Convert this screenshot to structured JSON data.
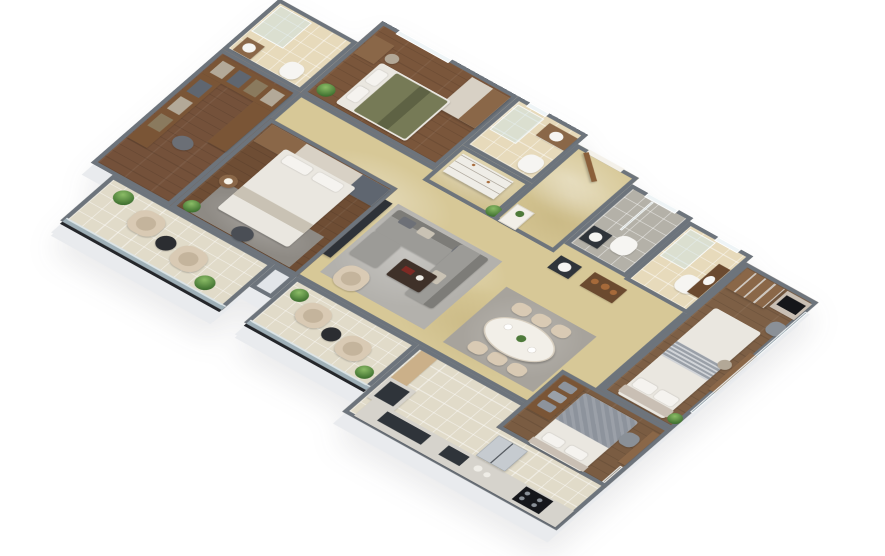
{
  "scene": {
    "description": "3D isometric cutaway render of a furnished 3-bedroom apartment floor plan on a white background",
    "view": "isometric top-down 3D render",
    "background": "#ffffff",
    "label": "3D apartment floor plan render"
  },
  "colors": {
    "white": "#ffffff",
    "wall": "#6d747c",
    "wallLight": "#c9ccd1",
    "gapWall": "#e2e5e9",
    "marbleFloor": "#d7c897",
    "floorWoodBed1": "#7a563b",
    "floorWoodBed2": "#6e4d34",
    "floorWoodMaster": "#7d5f45",
    "floorWoodBed3": "#7a5c42",
    "floorWoodCloset": "#74513a",
    "tileBeige": "#e7dabb",
    "tileCream": "#e1dbc9",
    "tileGray": "#b4b1a8",
    "bedGreen": "#767a56",
    "bedGreenDark": "#5e6244",
    "duvetWhite": "#eae7e0",
    "blanketGray": "#8d939c",
    "stripeGray": "#9aa0a8",
    "headboardTaupe": "#c9bfb4",
    "sofaGray": "#9c9b97",
    "sofaDark": "#7d7c78",
    "cushionDark": "#6d7077",
    "cushionBeige": "#c9c2b4",
    "rugLiving": "#b3b1ac",
    "rugDining": "#a7a39c",
    "rugBedroom": "#8e8a84",
    "armchairCream": "#d9cab4",
    "armchairShade": "#c4b49c",
    "tableBlack": "#2b2d31",
    "coffeeTableWood": "#3f3129",
    "woodFurniture": "#8a6748",
    "woodDark": "#6b4a2f",
    "shelfWood": "#7a5536",
    "creamPanel": "#d8d1c5",
    "dresserWhite": "#efede7",
    "marbleTop": "#f2efe8",
    "toiletWhite": "#f6f5f2",
    "counterLight": "#d6d3cc",
    "counterDark": "#2f343a",
    "applianceSteel": "#c6cbd0",
    "cooktopBlack": "#15161a",
    "tvBlack": "#15161a",
    "mediaWall": "#2e3238",
    "doorWood": "#8a5f3a",
    "partitionWood": "#cbb089",
    "plantGreen": "#4e7a3a",
    "potWhite": "#d8d5cf",
    "lampWhite": "#f7f4ea",
    "accentRed": "#7e2a24",
    "copperPot": "#a66a3a",
    "chairWicker": "#b3a897",
    "grayChair": "#8a9097",
    "clothesDark": "#5f6670",
    "clothesTan": "#8a7a5e",
    "clothesLight": "#b3a998",
    "poufDark": "#4a4e55",
    "ottomanGray": "#6b6f76",
    "glassRail": "#cde2e9",
    "railBase": "#24262a"
  },
  "rooms": [
    {
      "id": "bedroom-1",
      "label": "Bedroom 1 with olive-green double bed, wardrobe, study desk and window",
      "floor": "dark wood planks",
      "furniture": [
        "double-bed-olive",
        "wardrobe-two-tone",
        "study-desk",
        "desk-chair",
        "window",
        "potted-plant"
      ]
    },
    {
      "id": "ensuite-bathroom-1",
      "label": "En-suite bathroom with glass shower, vanity sink and toilet",
      "floor": "beige tile",
      "furniture": [
        "glass-shower",
        "vanity-sink",
        "toilet",
        "window"
      ]
    },
    {
      "id": "dressing-area",
      "label": "Dressing area with white chest of drawers and plant",
      "floor": "marble",
      "furniture": [
        "chest-of-drawers",
        "potted-plant"
      ]
    },
    {
      "id": "foyer",
      "label": "Entrance foyer with open wooden entry door and console",
      "floor": "marble",
      "furniture": [
        "entry-door",
        "console-table"
      ]
    },
    {
      "id": "common-bathroom",
      "label": "Common bathroom with grey tiling, wash basin and toilet",
      "floor": "grey tile",
      "furniture": [
        "wash-basin",
        "toilet",
        "window",
        "glass-partition"
      ]
    },
    {
      "id": "guest-bathroom",
      "label": "Guest bathroom with shower, wall-hung toilet and vanity",
      "floor": "beige tile",
      "furniture": [
        "glass-shower",
        "toilet",
        "vanity-sink",
        "window"
      ]
    },
    {
      "id": "master-bedroom",
      "label": "Master bedroom with glass-door wardrobe, TV panel, white bed, chair and dressing desk along window wall",
      "floor": "wood planks",
      "furniture": [
        "glass-door-wardrobe",
        "tv-panel",
        "double-bed-white-striped",
        "accent-chair",
        "dressing-desk",
        "stool",
        "potted-plant",
        "window-wall"
      ]
    },
    {
      "id": "ensuite-bathroom-2",
      "label": "En-suite bathroom with corner shower, toilet and small sink",
      "floor": "beige tile",
      "furniture": [
        "glass-shower",
        "toilet",
        "wash-basin"
      ]
    },
    {
      "id": "bedroom-2",
      "label": "Bedroom 2 with white double bed, headboard wardrobe wall, bedside lamp table, rug, pouf and TV wall",
      "floor": "dark wood planks",
      "furniture": [
        "double-bed-white",
        "headboard-wardrobe",
        "bedside-table",
        "table-lamp",
        "rug",
        "pouf",
        "tv-media-wall",
        "potted-plant"
      ]
    },
    {
      "id": "walk-in-closet",
      "label": "Walk-in closet with open wooden shelving and ottoman",
      "floor": "dark wood planks",
      "furniture": [
        "wardrobe-shelving",
        "ottoman"
      ]
    },
    {
      "id": "living-area",
      "label": "Living area with grey L-shaped sectional sofa, coffee table, armchair on grey rug",
      "floor": "beige marble",
      "furniture": [
        "sectional-sofa",
        "coffee-table",
        "armchair",
        "rug",
        "media-wall"
      ]
    },
    {
      "id": "dining-area",
      "label": "Dining area with oval marble table and six upholstered chairs on rug",
      "floor": "beige marble",
      "furniture": [
        "oval-dining-table",
        "dining-chairs",
        "rug",
        "table-decor"
      ]
    },
    {
      "id": "kitchen",
      "label": "Open kitchen with L-shaped counter, dark sink, gas cooktop, steel refrigerator and wood partition",
      "floor": "cream tile",
      "furniture": [
        "counter-run",
        "counter-return",
        "sink",
        "cooktop",
        "refrigerator",
        "partition",
        "countertop-decor"
      ]
    },
    {
      "id": "bedroom-3",
      "label": "Bedroom 3 with grey-blanket bed, pillow shelf, desk and chair at window wall",
      "floor": "wood planks",
      "furniture": [
        "double-bed-grey",
        "pillow-shelf",
        "desk",
        "desk-chair",
        "window-wall"
      ]
    },
    {
      "id": "balcony-1",
      "label": "Balcony with two cream armchairs, round black table, plants and glass railing",
      "floor": "cream tile",
      "furniture": [
        "armchair",
        "armchair",
        "round-table",
        "potted-plant",
        "potted-plant",
        "glass-railing"
      ]
    },
    {
      "id": "balcony-2",
      "label": "Balcony with two cream armchairs, round black table, plants and glass railing",
      "floor": "cream tile",
      "furniture": [
        "armchair",
        "armchair",
        "round-table",
        "potted-plant",
        "potted-plant",
        "glass-railing"
      ]
    },
    {
      "id": "corridor",
      "label": "Corridor / common area with wash-basin counter and display shelf",
      "floor": "beige marble",
      "furniture": [
        "wash-basin-counter",
        "display-shelf"
      ]
    }
  ]
}
